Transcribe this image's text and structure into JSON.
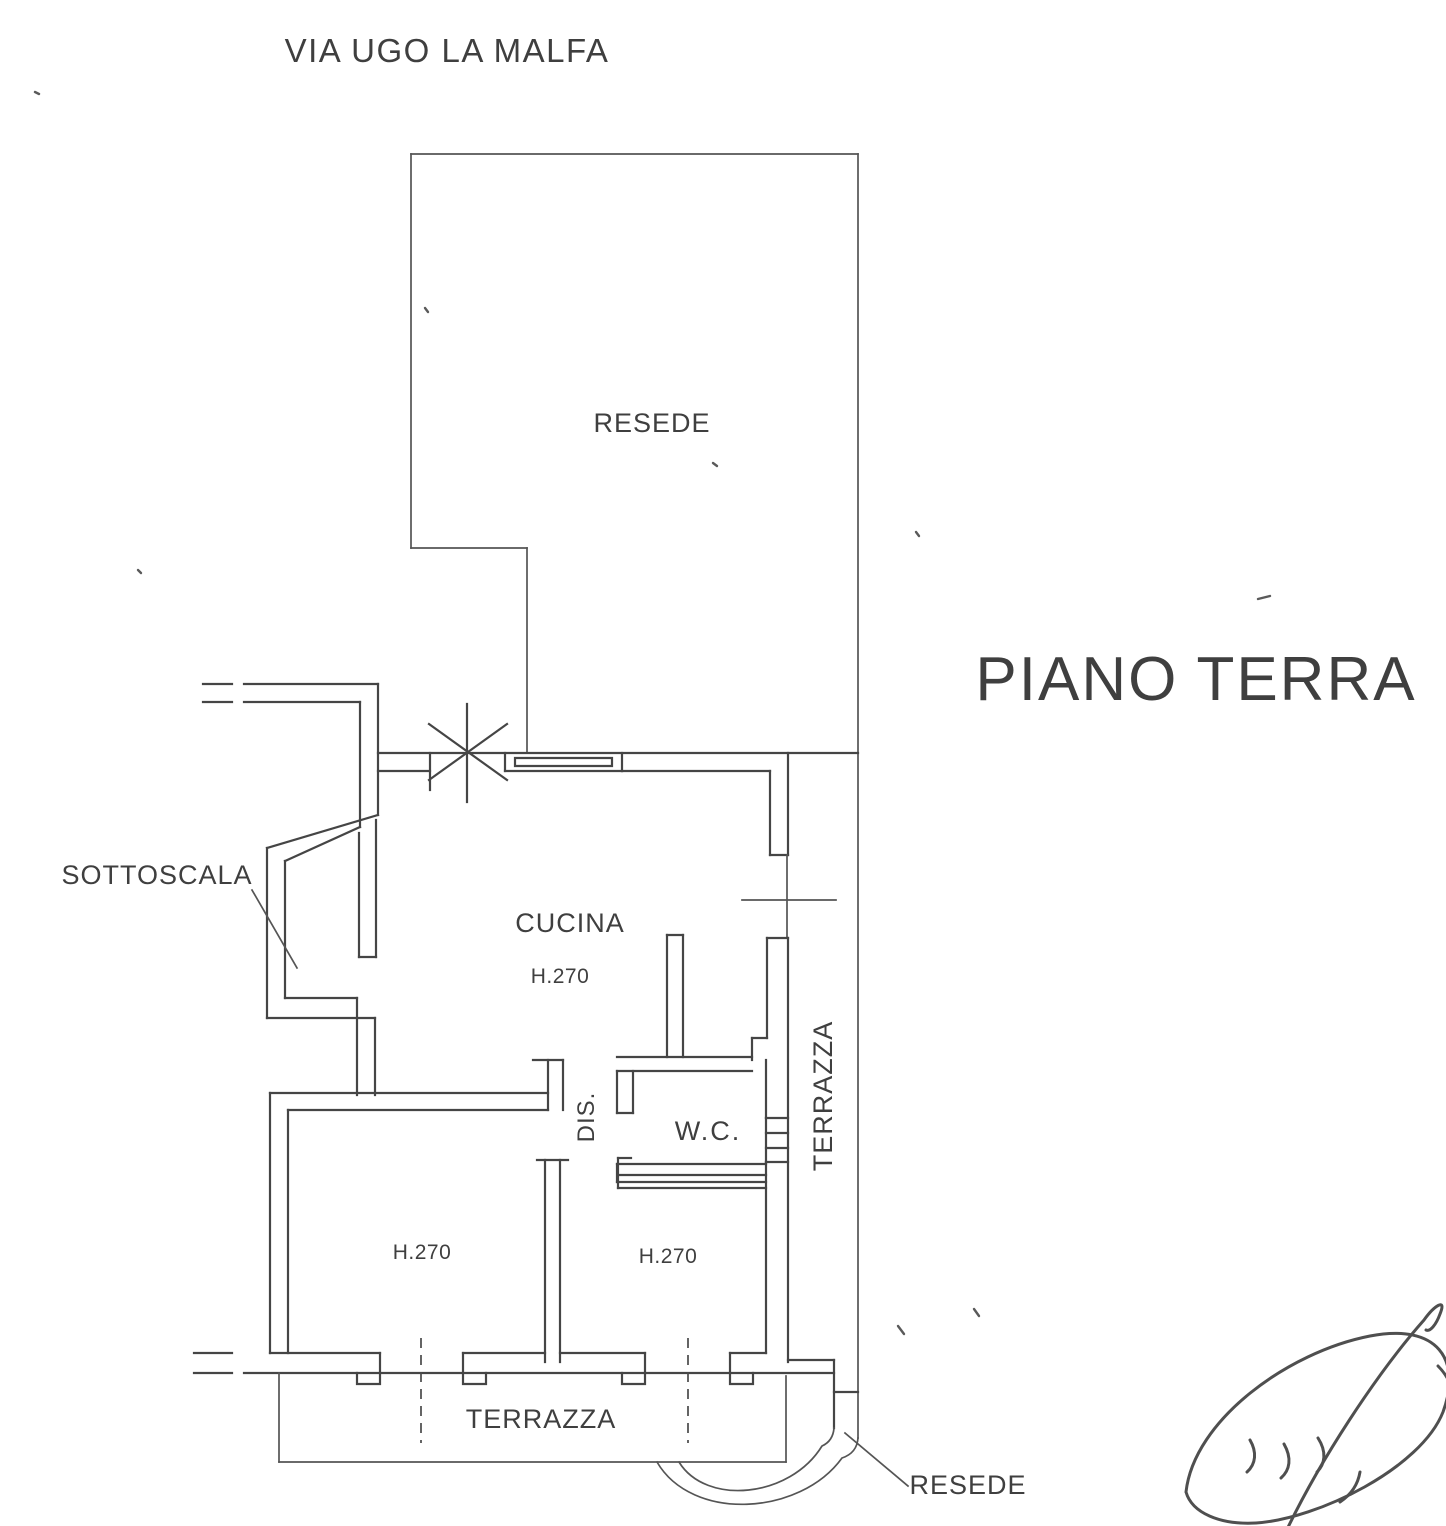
{
  "header": {
    "street": "VIA UGO LA MALFA",
    "floor_title": "PIANO TERRA"
  },
  "labels": {
    "resede_top": "RESEDE",
    "sottoscala": "SOTTOSCALA",
    "cucina": "CUCINA",
    "cucina_height": "H.270",
    "dis": "DIS.",
    "wc": "W.C.",
    "terrazza_side": "TERRAZZA",
    "room_left_height": "H.270",
    "room_right_height": "H.270",
    "terrazza_bottom": "TERRAZZA",
    "resede_bottom": "RESEDE"
  },
  "colors": {
    "ink": "#454545",
    "paper": "#ffffff"
  }
}
